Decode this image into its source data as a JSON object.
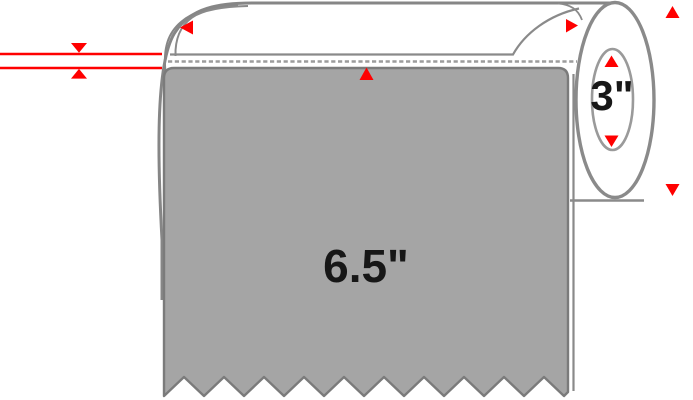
{
  "diagram": {
    "subject": "label-roll-dimension-diagram",
    "label_sheet": {
      "width_text": "6.5\""
    },
    "core": {
      "diameter_text": "3\""
    },
    "colors": {
      "background": "#FFFFFF",
      "label_fill": "#A5A5A5",
      "label_outline": "#7B7B7B",
      "roll_outline": "#868686",
      "dashed_line": "#9C9C9C",
      "annotation_red": "#FF0000",
      "dimension_text": "#171717"
    },
    "annotations": {
      "thickness_measure_lines": 2,
      "arrows": [
        {
          "name": "thickness-arrow-down",
          "direction": "down"
        },
        {
          "name": "thickness-arrow-up",
          "direction": "up"
        },
        {
          "name": "roll-edge-arrow-left",
          "direction": "left"
        },
        {
          "name": "label-top-arrow-up",
          "direction": "up"
        },
        {
          "name": "unwind-arrow-right",
          "direction": "right"
        },
        {
          "name": "outer-diameter-arrow-up",
          "direction": "up"
        },
        {
          "name": "outer-diameter-arrow-down",
          "direction": "down"
        },
        {
          "name": "core-arrow-up",
          "direction": "up"
        },
        {
          "name": "core-arrow-down",
          "direction": "down"
        }
      ]
    }
  }
}
